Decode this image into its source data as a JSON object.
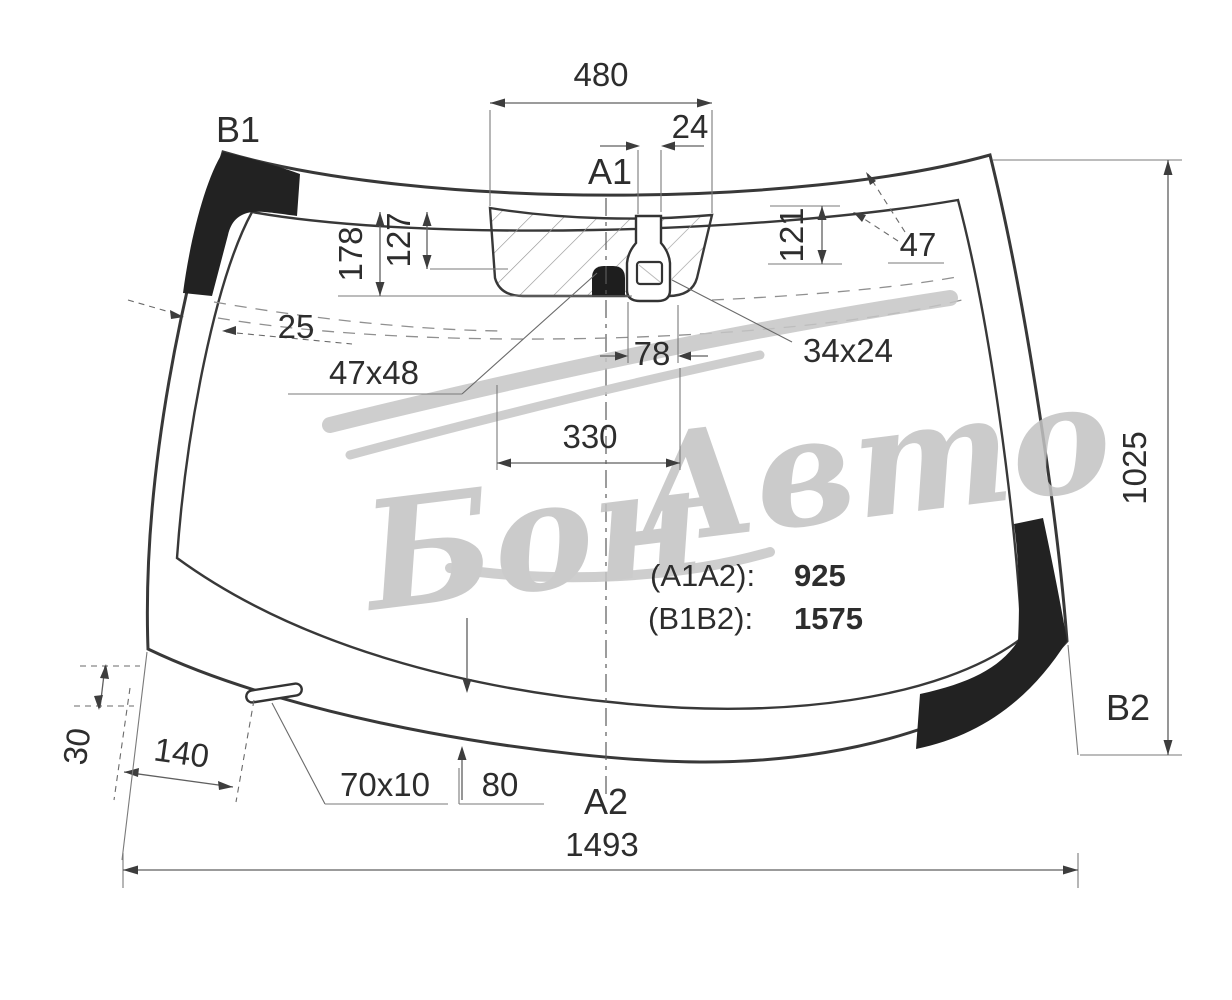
{
  "drawing": {
    "type": "windshield-glass-technical-diagram",
    "labels": {
      "b1": "B1",
      "a1": "A1",
      "a2": "A2",
      "b2": "B2"
    },
    "dims": {
      "top_width": "480",
      "sensor_offset": "24",
      "band_left_a": "178",
      "band_left_b": "127",
      "band_right": "121",
      "corner_band": "47",
      "edge_width": "25",
      "mount_size": "47x48",
      "sensor_gap": "78",
      "bracket_width": "330",
      "sensor_size": "34x24",
      "height": "1025",
      "slot_offset_v": "30",
      "slot_offset_h": "140",
      "slot_size": "70x10",
      "bottom_band": "80",
      "bottom_width": "1493"
    },
    "notes": {
      "l1_label": "(A1A2):",
      "l1_value": "925",
      "l2_label": "(B1B2):",
      "l2_value": "1575"
    },
    "watermark": {
      "w1": "Бон",
      "w2": "Авто"
    },
    "colors": {
      "line": "#383838",
      "dimension": "#5f5f5f",
      "fill_black": "#222222",
      "watermark": "#c3c3c3",
      "background": "#ffffff"
    }
  }
}
